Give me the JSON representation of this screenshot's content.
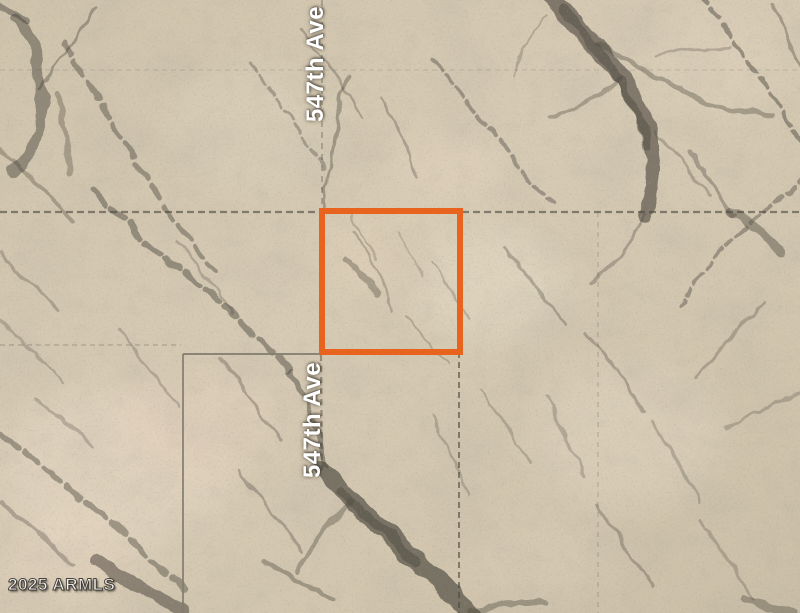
{
  "map": {
    "road_labels": [
      {
        "id": "top",
        "text": "547th Ave"
      },
      {
        "id": "middle",
        "text": "547th Ave"
      }
    ],
    "watermark": "2025 ARMLS",
    "colors": {
      "parcel_outline": "#E8641E",
      "terrain_base": "#D2C6AF",
      "terrain_wash_dark": "#4E4940",
      "grid_line_dark": "#4A463E",
      "grid_line_gray": "#827D70",
      "road_label_text": "#FFFFFF",
      "watermark_text": "#F5F3EF"
    }
  }
}
